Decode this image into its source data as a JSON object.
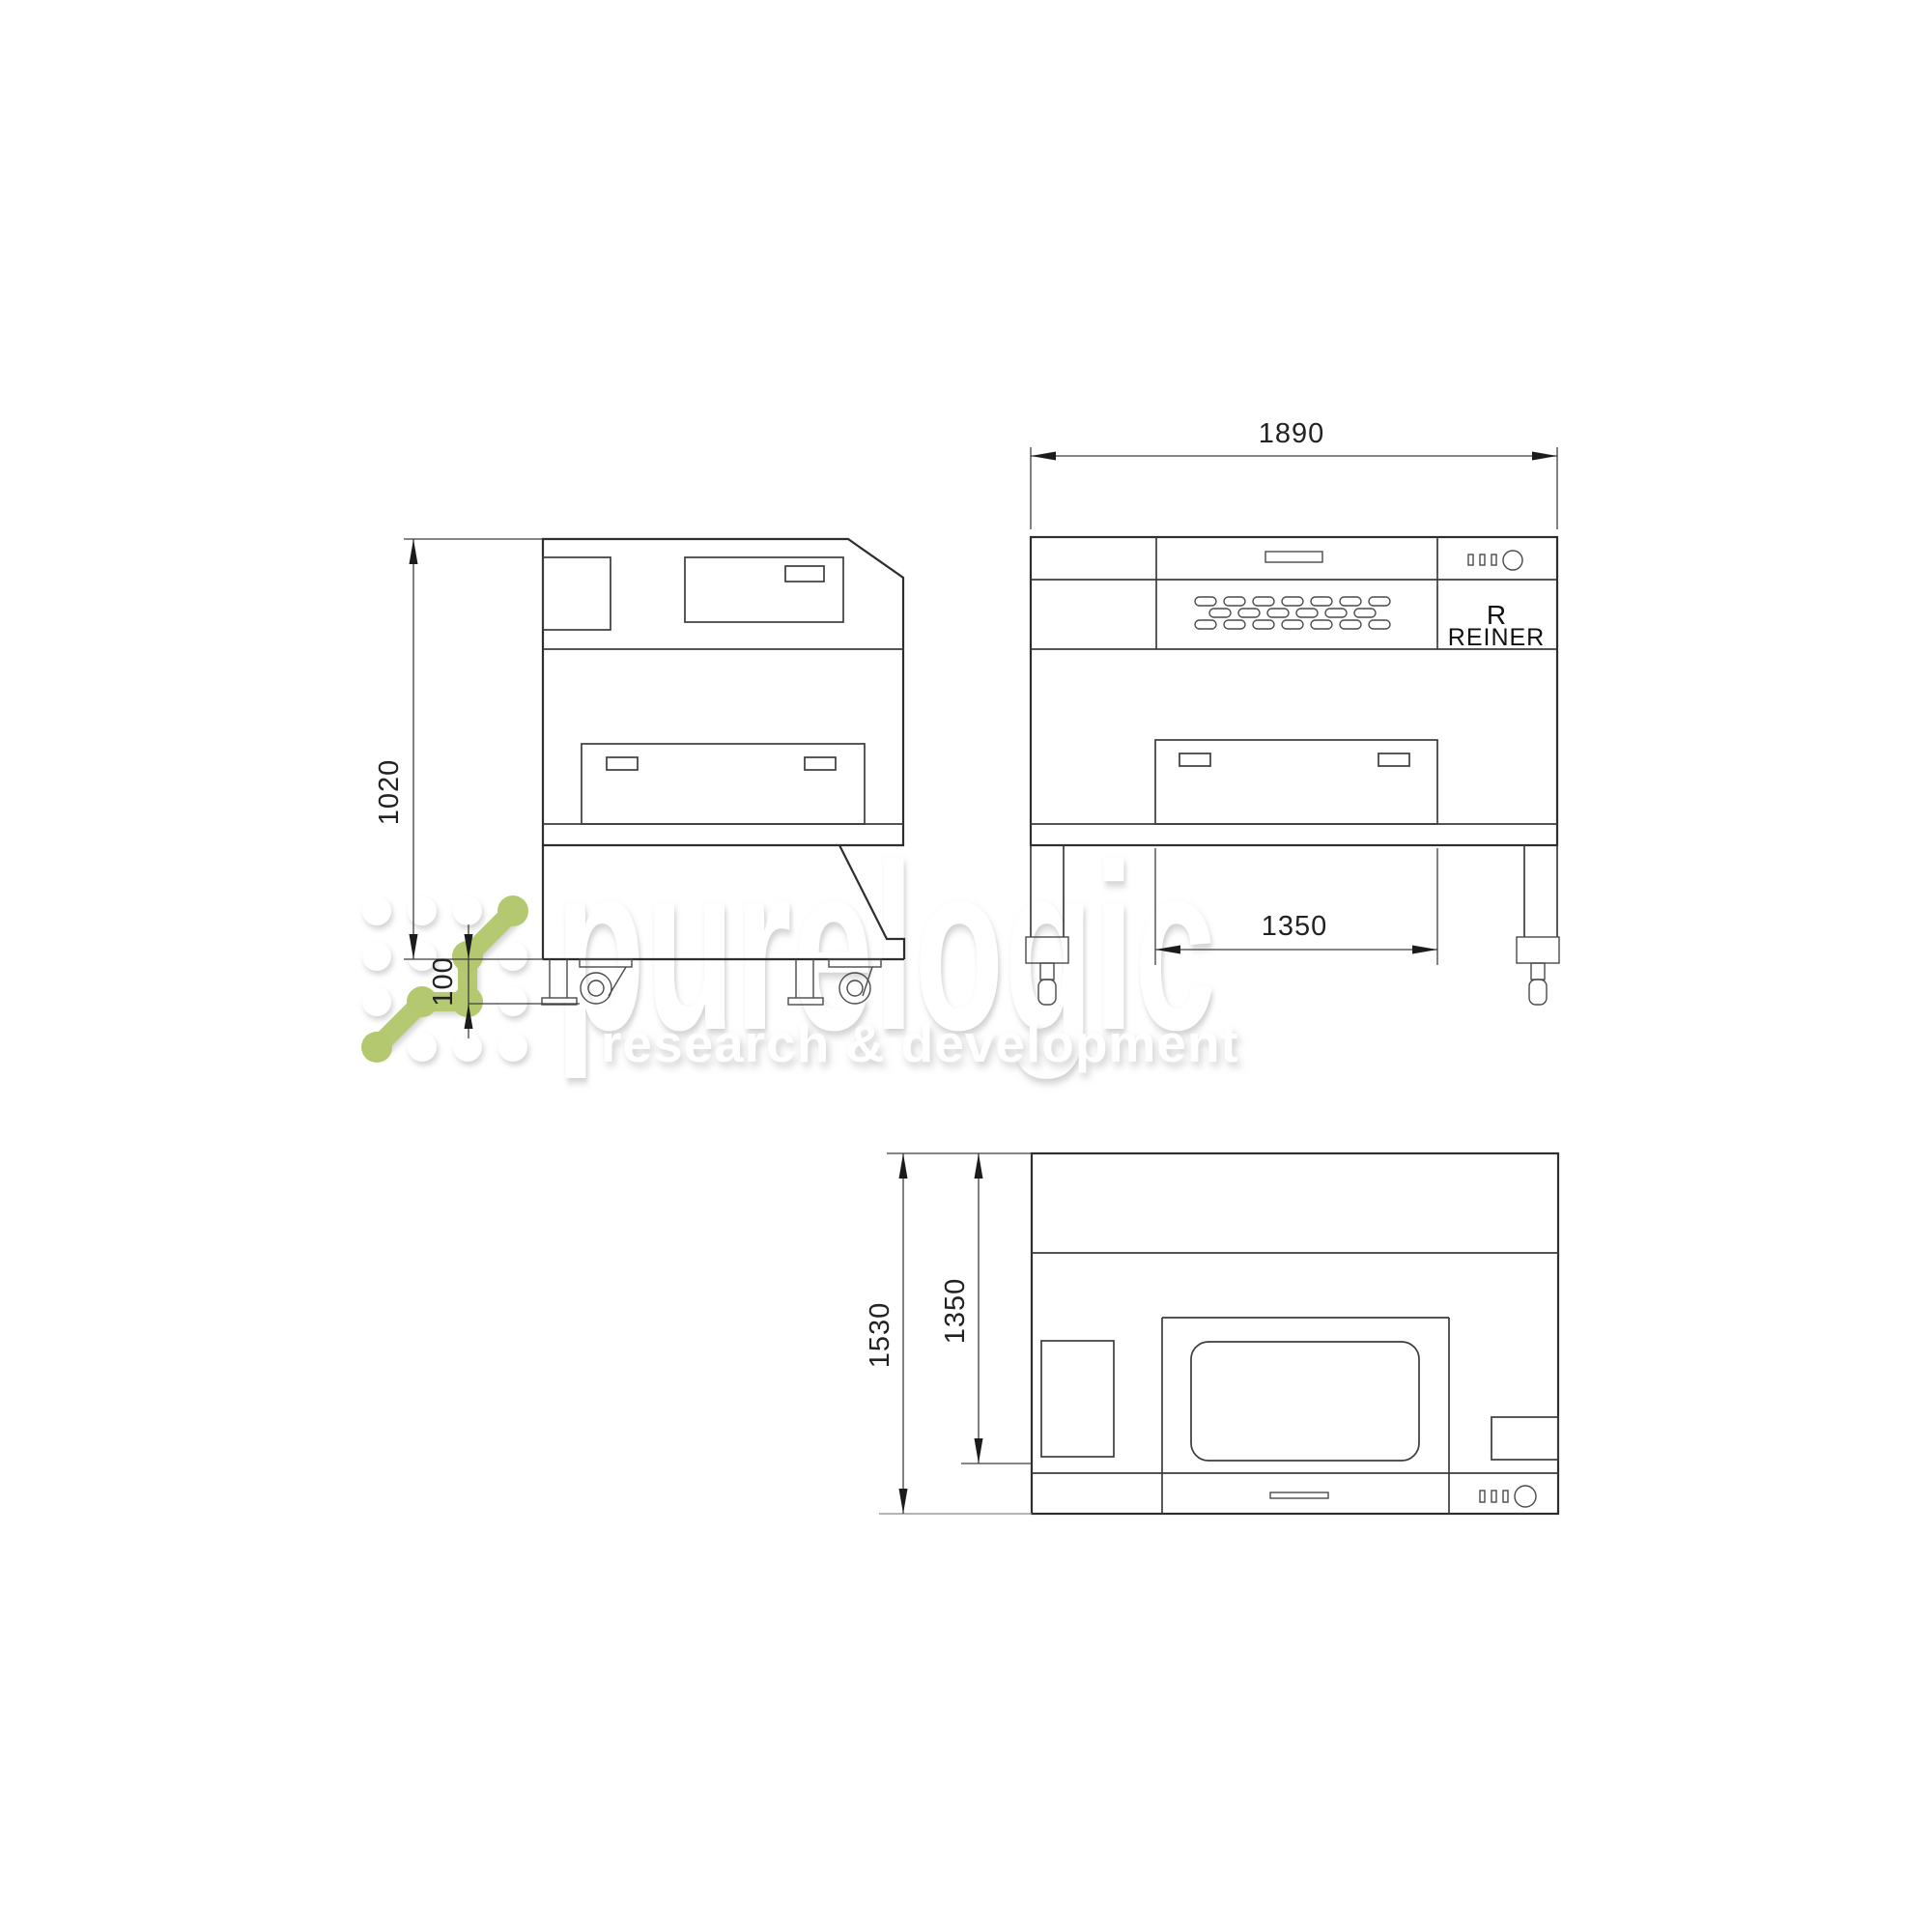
{
  "watermark": {
    "brand": "purelogic",
    "tagline": "research & development",
    "accent_color": "#b4c96f"
  },
  "brand_panel": {
    "line1": "R",
    "line2": "REINER"
  },
  "dimensions": {
    "front_width": "1890",
    "side_height": "1020",
    "base_height": "100",
    "front_door_width": "1350",
    "top_depth": "1530",
    "top_inner_depth": "1350"
  }
}
